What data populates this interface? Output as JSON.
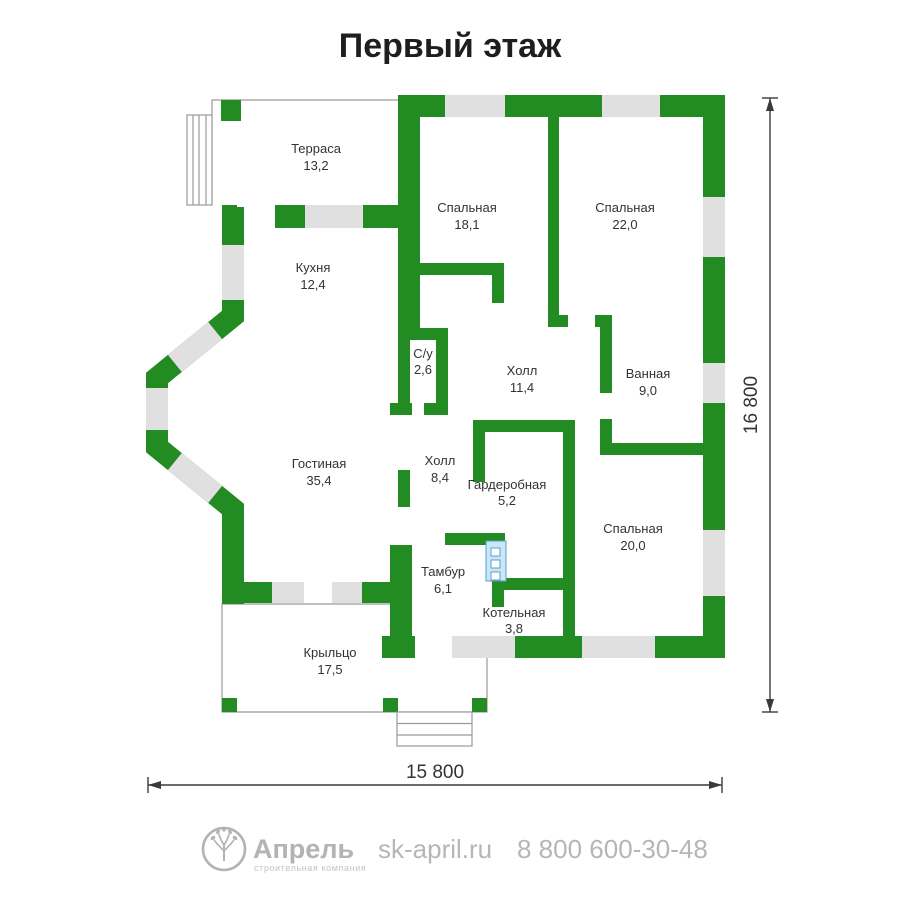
{
  "title": "Первый этаж",
  "plan": {
    "floor_color": "#ffffff",
    "wall_color": "#228b22",
    "window_color": "#e0e0e0",
    "shaft_color": "#c9e7f6",
    "rooms": [
      {
        "name": "Терраса",
        "area": "13,2"
      },
      {
        "name": "Кухня",
        "area": "12,4"
      },
      {
        "name": "Спальная",
        "area": "18,1"
      },
      {
        "name": "Спальная",
        "area": "22,0"
      },
      {
        "name": "С/у",
        "area": "2,6"
      },
      {
        "name": "Холл",
        "area": "11,4"
      },
      {
        "name": "Ванная",
        "area": "9,0"
      },
      {
        "name": "Гостиная",
        "area": "35,4"
      },
      {
        "name": "Холл",
        "area": "8,4"
      },
      {
        "name": "Гардеробная",
        "area": "5,2"
      },
      {
        "name": "Спальная",
        "area": "20,0"
      },
      {
        "name": "Тамбур",
        "area": "6,1"
      },
      {
        "name": "Котельная",
        "area": "3,8"
      },
      {
        "name": "Крыльцо",
        "area": "17,5"
      }
    ]
  },
  "dimensions": {
    "height": "16 800",
    "width": "15 800"
  },
  "footer": {
    "brand": "Апрель",
    "tagline": "строительная компания",
    "website": "sk-april.ru",
    "phone": "8 800 600-30-48",
    "text_color": "#b3b3b3"
  }
}
